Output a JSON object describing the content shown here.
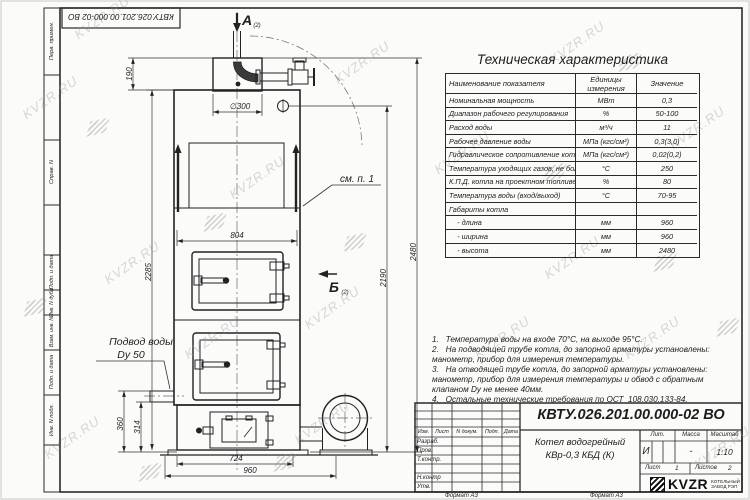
{
  "watermark": {
    "text": "KVZR.RU"
  },
  "frame_stamp_top": "КВТУ.026.201.00.000-02  ВО",
  "side_fields": {
    "f0": "Перв. примен.",
    "f1": "Справ. N",
    "f2": "Подп. и дата",
    "f3": "Инв. N дубл.",
    "f4": "Взам. инв. N",
    "f5": "Подп. и дата",
    "f6": "Инв. N подл."
  },
  "table": {
    "title": "Техническая характеристика",
    "headers": [
      "Наименование показателя",
      "Единицы\nизмерения",
      "Значение"
    ],
    "rows": [
      {
        "name": "Номинальная мощность",
        "unit": "МВт",
        "value": "0,3"
      },
      {
        "name": "Диапазон рабочего регулирования",
        "unit": "%",
        "value": "50-100"
      },
      {
        "name": "Расход воды",
        "unit": "м³/ч",
        "value": "11"
      },
      {
        "name": "Рабочее давление воды",
        "unit": "МПа (кгс/см²)",
        "value": "0,3(3,0)"
      },
      {
        "name": "Гидравлическое сопротивление котла",
        "unit": "МПа (кгс/см²)",
        "value": "0,02(0,2)"
      },
      {
        "name": "Температура уходящих газов, не более",
        "unit": "°С",
        "value": "250"
      },
      {
        "name": "К.П.Д. котла на проектном топливе",
        "unit": "%",
        "value": "80"
      },
      {
        "name": "Температура воды (вход/выход)",
        "unit": "°С",
        "value": "70-95"
      },
      {
        "name": "Габариты котла",
        "unit": "",
        "value": ""
      },
      {
        "name": "    - длина",
        "unit": "мм",
        "value": "960"
      },
      {
        "name": "    - ширина",
        "unit": "мм",
        "value": "960"
      },
      {
        "name": "    - высота",
        "unit": "мм",
        "value": "2480"
      }
    ]
  },
  "notes": [
    "1.   Температура воды на входе 70°С, на выходе 95°С.",
    "2.   На подводящей трубе котла, до запорной арматуры установлены:",
    "манометр, прибор для измерения температуры.",
    "3.   На отводящей трубе котла, до запорной арматуры установлены:",
    "манометр, прибор для измерения температуры и обвод с обратным",
    "клапаном Dу не менее 40мм.",
    "4.   Остальные технические требования по ОСТ  108.030.133-84."
  ],
  "drawing": {
    "section_a": "А",
    "view_b": "Б",
    "sheet_ref": "(2)",
    "see_note": "см. п. 1",
    "water_supply_line1": "Подвод воды",
    "water_supply_line2": "Dy 50",
    "dims": {
      "h190": "190",
      "dia300": "∅300",
      "w804": "804",
      "h2285": "2285",
      "h2190": "2190",
      "h2480": "2480",
      "h360": "360",
      "h314": "314",
      "w724": "724",
      "w960": "960"
    }
  },
  "title_block": {
    "doc_number": "КВТУ.026.201.00.000-02  ВО",
    "product_line1": "Котел водогрейный",
    "product_line2": "КВр-0,3 КБД (К)",
    "header_cols": {
      "c0": "Изм.",
      "c1": "Лист",
      "c2": "N докум.",
      "c3": "Подп.",
      "c4": "Дата"
    },
    "row_labels": {
      "r0": "Разраб.",
      "r1": "Пров.",
      "r2": "Т.контр.",
      "r3": "Н.контр",
      "r4": "Утв."
    },
    "lit_label": "Лит.",
    "lit_value": "И",
    "mass_label": "Масса",
    "mass_value": "-",
    "scale_label": "Масштаб",
    "scale_value": "1:10",
    "sheet_label": "Лист",
    "sheet_value": "1",
    "sheets_label": "Листов",
    "sheets_value": "2",
    "logo_text": "KVZR",
    "logo_sub1": "КОТЕЛЬНЫЙ",
    "logo_sub2": "ЗАВОД РЭП",
    "format_label_left": "Формат А3",
    "format_label_right": "Формат А3"
  }
}
